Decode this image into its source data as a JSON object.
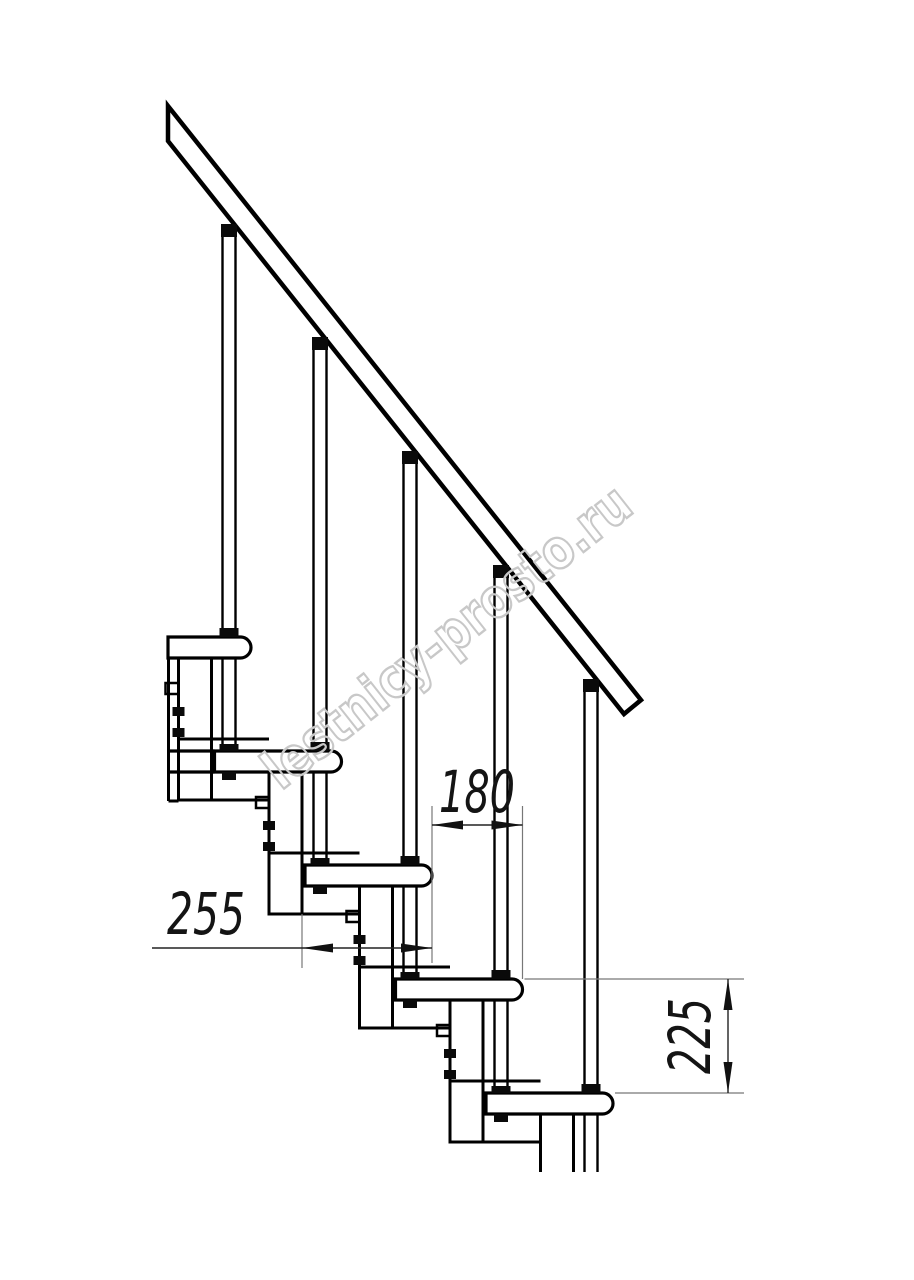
{
  "drawing": {
    "title": "modular staircase side elevation",
    "watermark": "lestnicy-prosto.ru",
    "dimensions": {
      "tread_depth": {
        "value": "255",
        "orientation": "horizontal",
        "measures": "tread depth (step board length)"
      },
      "step_run": {
        "value": "180",
        "orientation": "horizontal",
        "measures": "run between step nosings"
      },
      "riser_height": {
        "value": "225",
        "orientation": "vertical",
        "measures": "height between consecutive treads"
      }
    },
    "colors": {
      "line": "#000000",
      "dim_line": "#444444",
      "extension_line": "#777777",
      "watermark": "#c8c8c8",
      "background": "#ffffff"
    }
  }
}
